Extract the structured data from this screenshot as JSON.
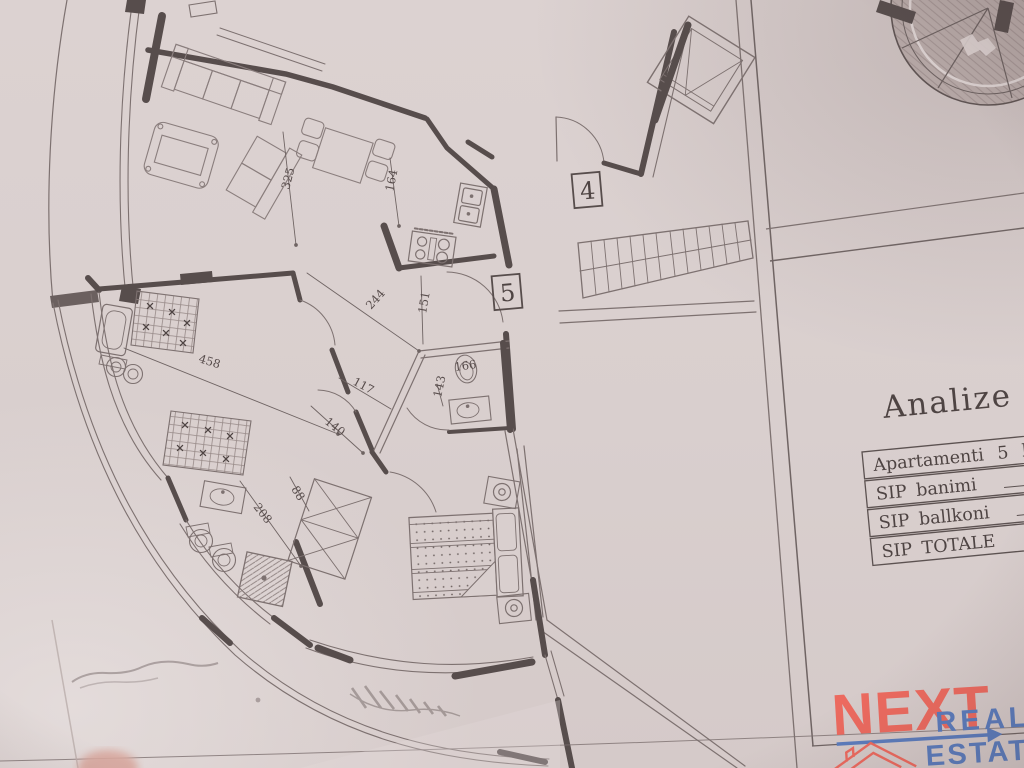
{
  "panel": {
    "title": "Analize e",
    "table": {
      "rows": [
        "Apartamenti  5  kat",
        "SIP  banimi",
        "SIP  ballkoni",
        "SIP  TOTALE"
      ]
    }
  },
  "plan": {
    "unit_labels": [
      "4",
      "5"
    ],
    "dimensions": [
      "325",
      "164",
      "244",
      "151",
      "458",
      "117",
      "140",
      "143",
      "166",
      "88",
      "208"
    ]
  },
  "logo": {
    "next": "NEXT",
    "real": "REAL",
    "estate": "ESTATE",
    "colors": {
      "accent_red": "#ec6a5f",
      "accent_blue": "#5b7cbd"
    }
  }
}
